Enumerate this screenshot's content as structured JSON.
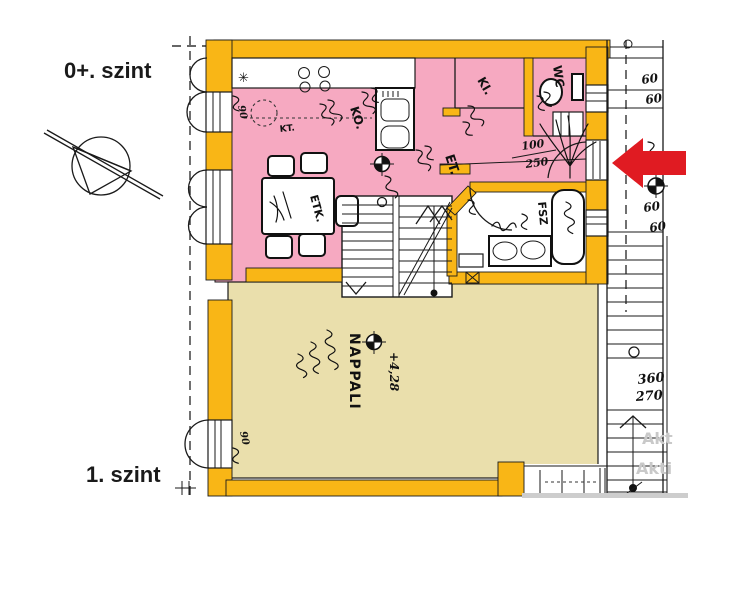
{
  "colors": {
    "wall_fill": "#F9B616",
    "upper_level_fill": "#F6A9C1",
    "lower_level_fill": "#EADFAC",
    "arrow_red": "#E01B22",
    "watermark_gray": "#C9C9C9"
  },
  "floor_labels": {
    "upper": "0+. szint",
    "lower": "1. szint"
  },
  "rooms": {
    "kitchen": "KO.",
    "dining": "ET.",
    "dining_table": "ETK.",
    "pantry": "KI.",
    "wc": "WC",
    "bathroom": "FSZ",
    "living_room": "NAPPALI",
    "side_table": "KT."
  },
  "annotations": {
    "level_mark": "+4,28",
    "entry_door": {
      "width": "100",
      "height": "250"
    },
    "ext_stair": {
      "width": "360",
      "height": "270"
    },
    "dims_60": [
      "60",
      "60",
      "60",
      "60"
    ],
    "window_90": [
      "90",
      "90"
    ],
    "asterisk": "✳"
  },
  "watermark": {
    "line1": "Akt",
    "line2": "Akti"
  }
}
